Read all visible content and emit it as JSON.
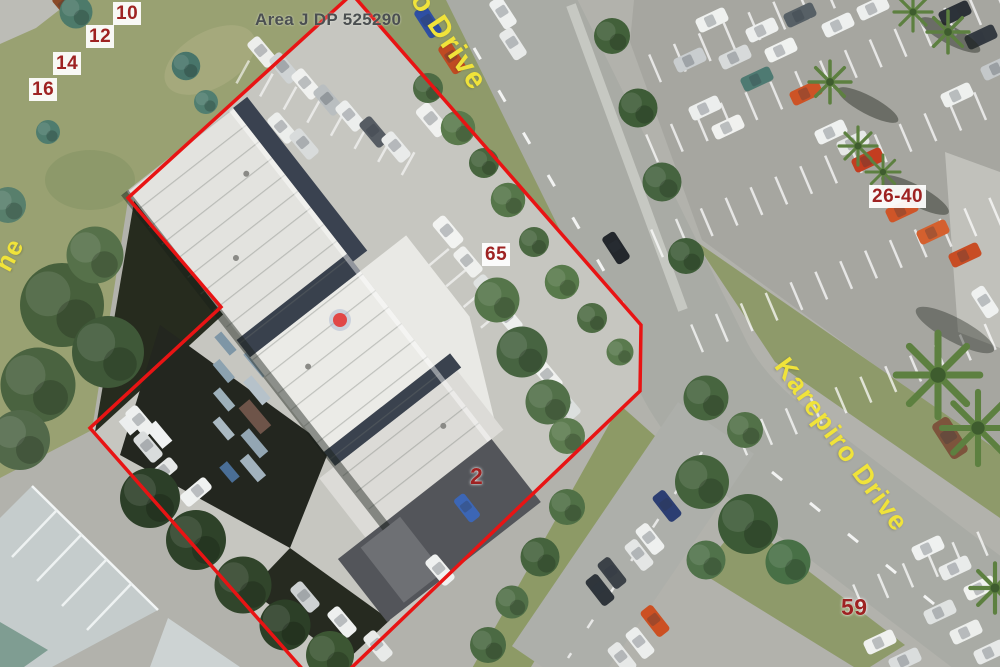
{
  "map": {
    "parcel": {
      "area_label": "Area J DP 525290",
      "boundary_color": "#e81414",
      "boundary_points": [
        [
          305,
          672
        ],
        [
          90,
          428
        ],
        [
          221,
          307
        ],
        [
          128,
          198
        ],
        [
          352,
          -6
        ],
        [
          641,
          325
        ],
        [
          640,
          391
        ],
        [
          347,
          672
        ]
      ],
      "marker": {
        "x": 340,
        "y": 320,
        "color": "#e14747",
        "halo": "#9bb0d0"
      }
    },
    "address_labels": [
      {
        "text": "10",
        "x": 113,
        "y": 2,
        "bg": true
      },
      {
        "text": "12",
        "x": 86,
        "y": 25,
        "bg": true
      },
      {
        "text": "14",
        "x": 53,
        "y": 52,
        "bg": true
      },
      {
        "text": "16",
        "x": 29,
        "y": 78,
        "bg": true
      },
      {
        "text": "65",
        "x": 482,
        "y": 243,
        "bg": true
      },
      {
        "text": "26-40",
        "x": 869,
        "y": 185,
        "bg": true
      },
      {
        "text": "2",
        "x": 467,
        "y": 465,
        "bg": false
      },
      {
        "text": "59",
        "x": 838,
        "y": 596,
        "bg": false
      }
    ],
    "street_labels": [
      {
        "text": "ro Drive",
        "x": 424,
        "y": -26,
        "angle": 56,
        "size": 30
      },
      {
        "text": "Karepiro Drive",
        "x": 793,
        "y": 352,
        "angle": 54,
        "size": 27
      },
      {
        "text": "ne",
        "x": -12,
        "y": 262,
        "angle": -62,
        "size": 26
      }
    ],
    "label_colors": {
      "address_text": "#9e2222",
      "address_bg": "#ffffff",
      "street_text": "#f0e33a",
      "area_text": "#4b4f51"
    }
  }
}
